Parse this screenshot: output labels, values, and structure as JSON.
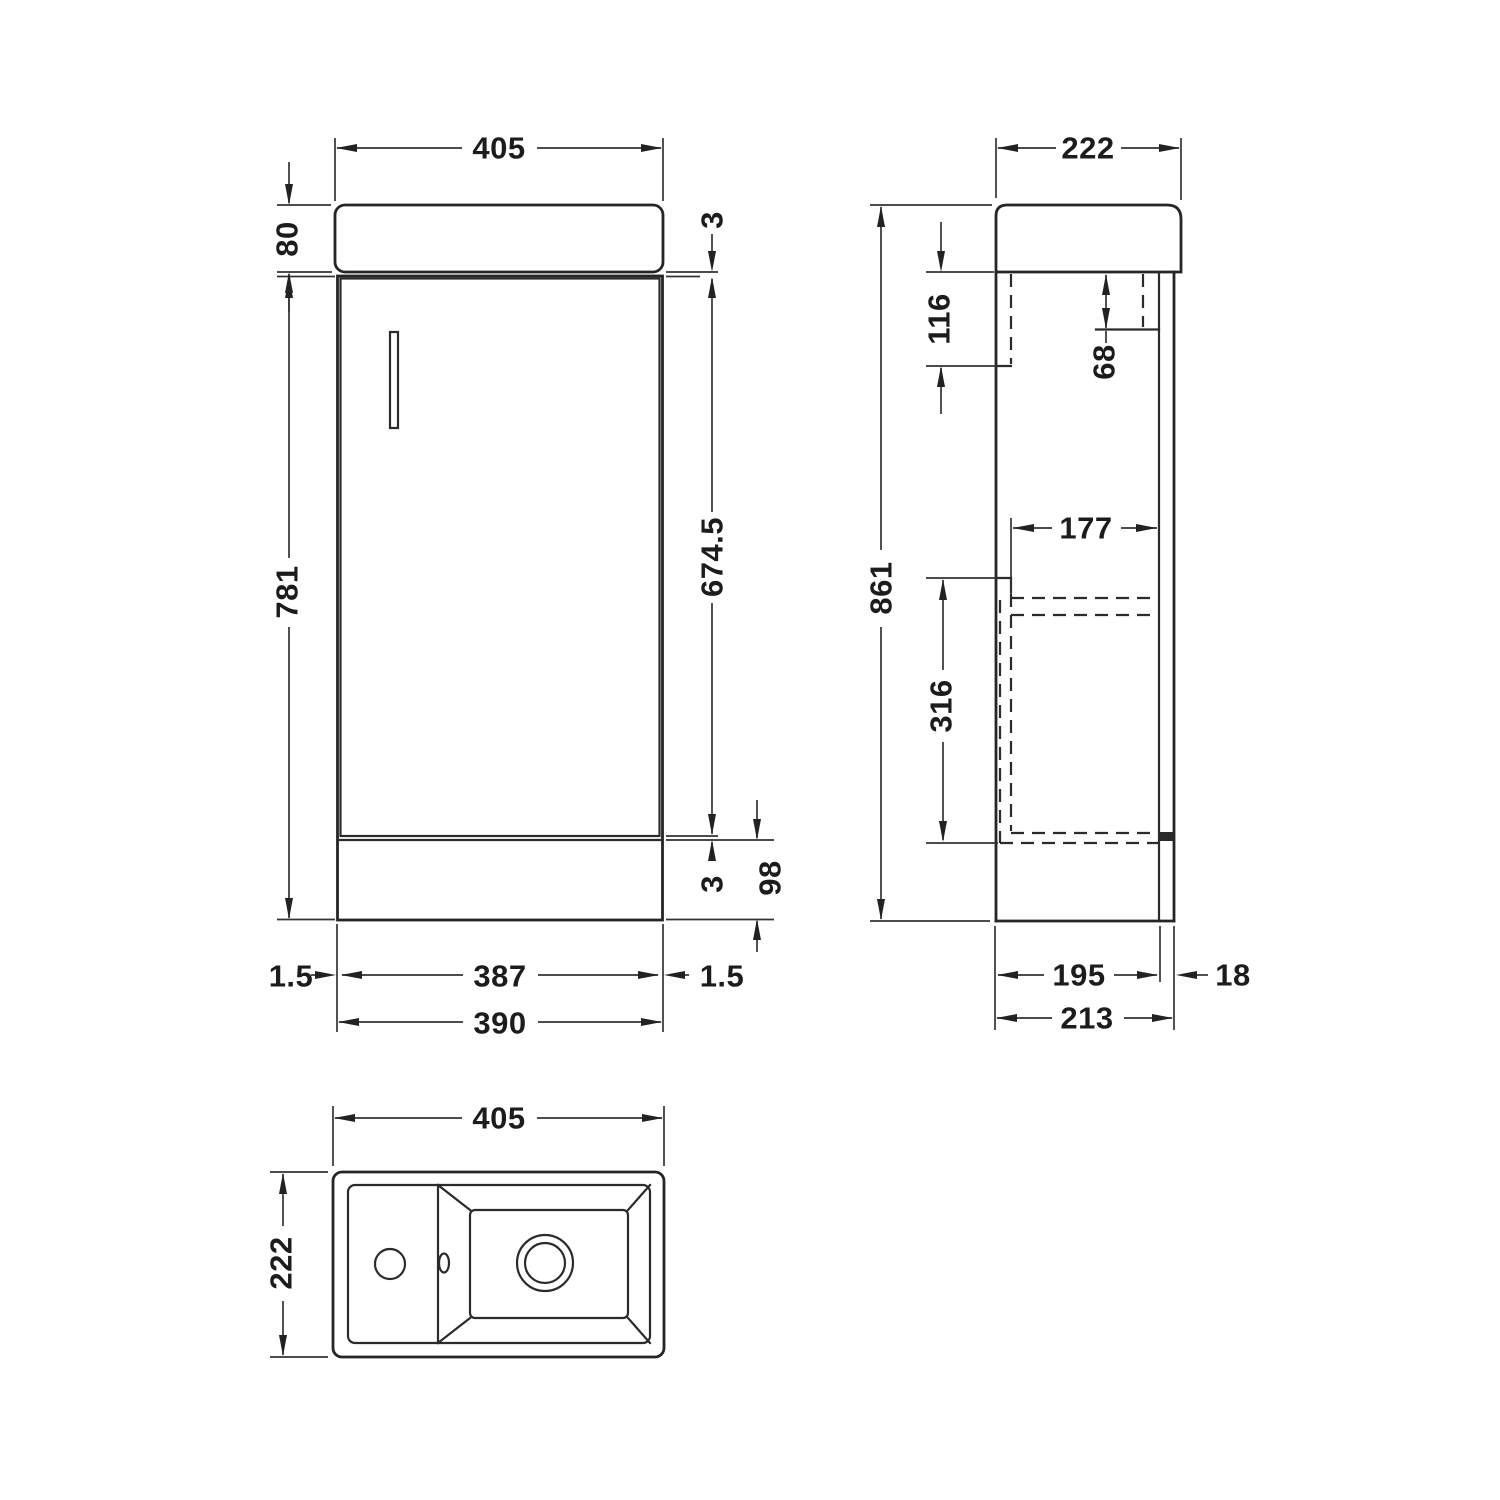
{
  "front": {
    "top_width": "405",
    "basin_height": "80",
    "top_gap": "3",
    "cabinet_height": "781",
    "door_height": "674.5",
    "bottom_gap": "3",
    "plinth_height": "98",
    "left_gap": "1.5",
    "door_width": "387",
    "right_gap": "1.5",
    "base_width": "390"
  },
  "side": {
    "top_depth": "222",
    "left_bracket_drop": "116",
    "right_bracket_drop": "68",
    "total_height": "861",
    "internal_depth": "177",
    "internal_height": "316",
    "body_depth": "195",
    "back_panel_thickness": "18",
    "base_depth": "213"
  },
  "plan": {
    "width": "405",
    "depth": "222"
  }
}
